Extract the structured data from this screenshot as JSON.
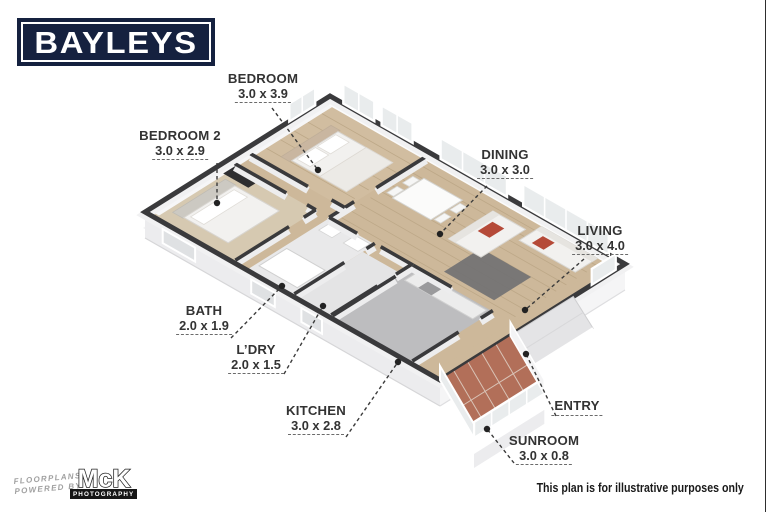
{
  "logo": {
    "text": "BAYLEYS",
    "bg_color": "#15213f",
    "border_color": "#ffffff"
  },
  "rooms": [
    {
      "id": "bedroom",
      "name": "BEDROOM",
      "dims": "3.0 x 3.9",
      "label_x": 263,
      "label_y": 72,
      "line": [
        272,
        108,
        318,
        170
      ]
    },
    {
      "id": "bedroom2",
      "name": "BEDROOM 2",
      "dims": "3.0 x 2.9",
      "label_x": 180,
      "label_y": 129,
      "line": [
        217,
        163,
        217,
        203
      ]
    },
    {
      "id": "dining",
      "name": "DINING",
      "dims": "3.0 x 3.0",
      "label_x": 505,
      "label_y": 148,
      "line": [
        487,
        186,
        440,
        234
      ]
    },
    {
      "id": "living",
      "name": "LIVING",
      "dims": "3.0 x 4.0",
      "label_x": 600,
      "label_y": 224,
      "line": [
        584,
        259,
        525,
        310
      ]
    },
    {
      "id": "bath",
      "name": "BATH",
      "dims": "2.0 x 1.9",
      "label_x": 204,
      "label_y": 304,
      "line": [
        231,
        338,
        282,
        286
      ]
    },
    {
      "id": "ldry",
      "name": "L’DRY",
      "dims": "2.0 x 1.5",
      "label_x": 256,
      "label_y": 343,
      "line": [
        284,
        374,
        323,
        306
      ]
    },
    {
      "id": "kitchen",
      "name": "KITCHEN",
      "dims": "3.0 x 2.8",
      "label_x": 316,
      "label_y": 404,
      "line": [
        346,
        437,
        398,
        362
      ]
    },
    {
      "id": "entry",
      "name": "ENTRY",
      "dims": null,
      "label_x": 577,
      "label_y": 399,
      "line": [
        556,
        416,
        526,
        354
      ]
    },
    {
      "id": "sunroom",
      "name": "SUNROOM",
      "dims": "3.0 x 0.8",
      "label_x": 544,
      "label_y": 434,
      "line": [
        514,
        463,
        487,
        429
      ]
    }
  ],
  "footer": {
    "powered_line1": "FLOORPLANS",
    "powered_line2": "POWERED BY",
    "mck": "McK",
    "photography": "PHOTOGRAPHY",
    "disclaimer": "This plan is for illustrative purposes only"
  },
  "colors": {
    "navy": "#15213f",
    "wall_dark": "#3a3a3c",
    "wall_face": "#ededee",
    "wood": "#cdb89a",
    "wood_bedroom": "#d1bda0",
    "wood_line": "#bda888",
    "carpet_beige": "#d6c9b1",
    "carpet_gray": "#bdbdbf",
    "bath_floor": "#e9e9ea",
    "ldry_floor": "#e4e4e5",
    "tile_terracotta": "#b26f59",
    "tile_grout": "#d9c3b6",
    "rug": "#707072",
    "cushion_red": "#b54a38",
    "glass": "#e9eced",
    "skirt": "#ececee",
    "skirt_light": "#f5f5f6",
    "porch": "#e4e4e6",
    "furniture_white": "#f2f1ef",
    "leader": "#3b3b3b",
    "dot": "#222222"
  }
}
